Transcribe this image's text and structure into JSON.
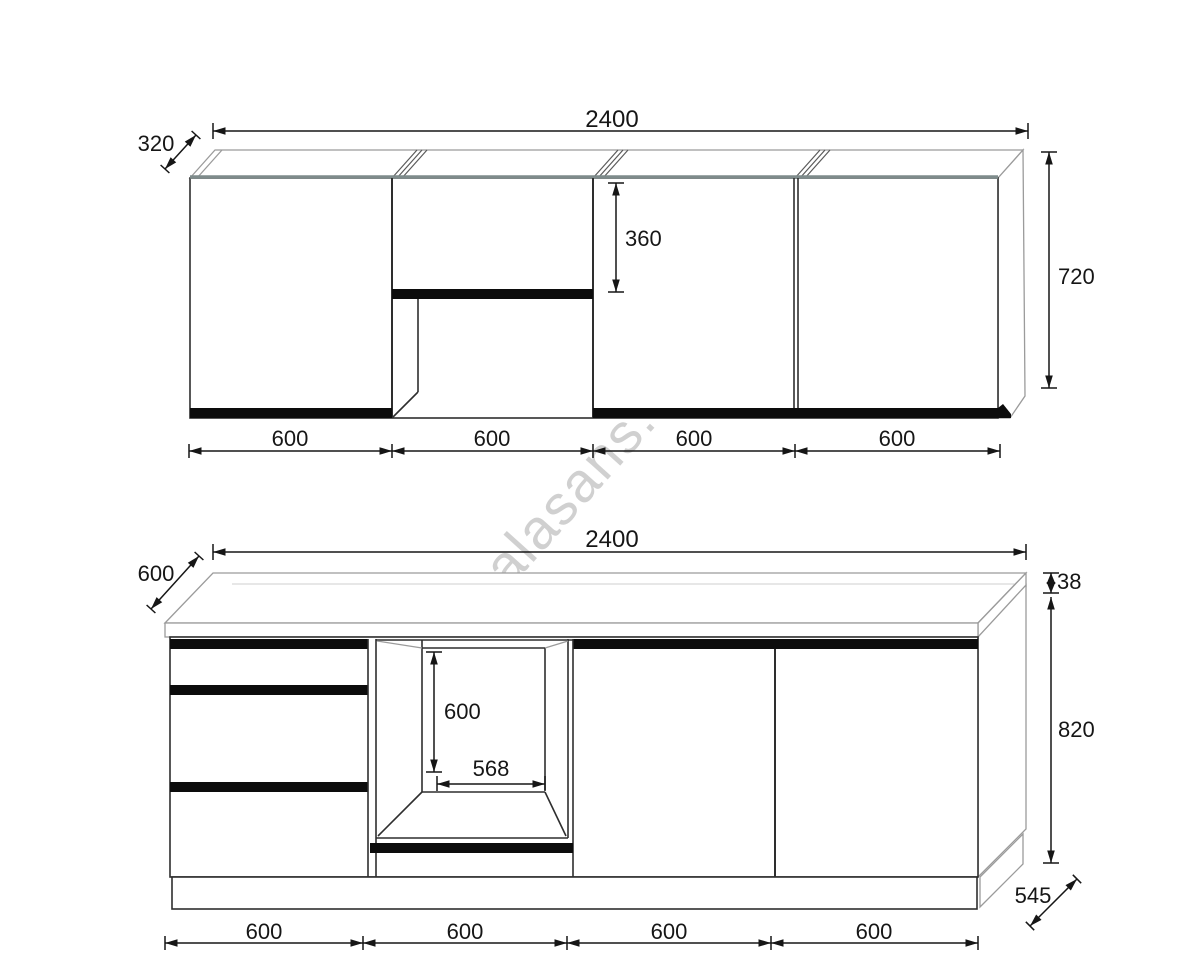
{
  "watermark": {
    "text": "alasans.at"
  },
  "upper_view": {
    "title": "wall cabinets elevation",
    "width_label": "2400",
    "depth_label": "320",
    "height_label": "720",
    "niche_label": "360",
    "sections": [
      "600",
      "600",
      "600",
      "600"
    ]
  },
  "lower_view": {
    "title": "base cabinets elevation",
    "width_label": "2400",
    "depth_label": "600",
    "worktop_label": "38",
    "height_label": "820",
    "side_depth_label": "545",
    "oven_height_label": "600",
    "oven_width_label": "568",
    "sections": [
      "600",
      "600",
      "600",
      "600"
    ]
  },
  "colors": {
    "line": "#2e2e2e",
    "black_fill": "#0c0c0c",
    "watermark": "#c5c5c5"
  }
}
